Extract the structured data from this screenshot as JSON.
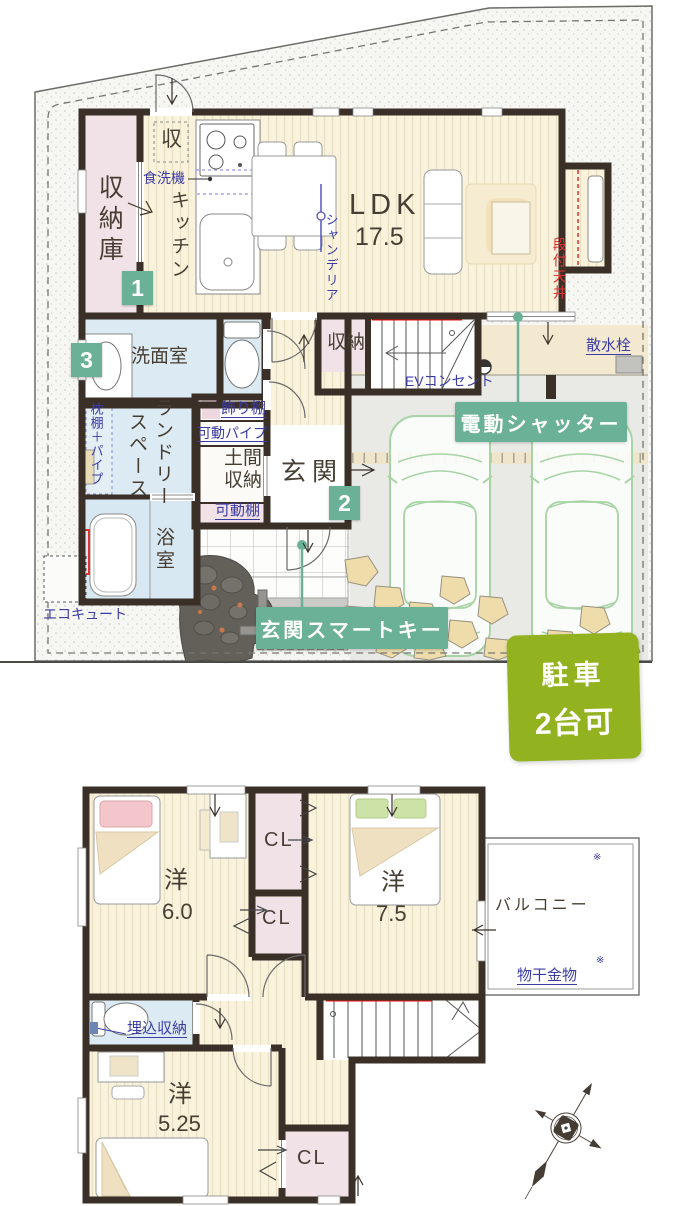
{
  "floor1": {
    "rooms": {
      "storage_room": "収納庫",
      "kitchen": "キッチン",
      "ldk": "LDK",
      "ldk_size": "17.5",
      "stair_storage": "収納",
      "washroom": "洗面室",
      "laundry_1": "ランドリー",
      "laundry_2": "スペース",
      "doma_1": "土間",
      "doma_2": "収納",
      "entrance": "玄関",
      "bathroom": "浴室"
    },
    "annotations": {
      "storage_small": "収",
      "dishwasher": "食洗機",
      "chandelier": "シャンデリア",
      "stepped_ceiling": "段付天井",
      "pillow_shelf": "枕棚＋パイプ",
      "display_shelf": "飾り棚",
      "movable_pipe": "可動パイプ",
      "movable_shelf": "可動棚",
      "ecocute": "エコキュート",
      "ev_outlet": "EVコンセント",
      "sprinkler": "散水栓"
    },
    "badges": {
      "storage": "1",
      "entrance": "2",
      "washroom": "3"
    },
    "callouts": {
      "electric_shutter": "電動シャッター",
      "smart_key": "玄関スマートキー"
    }
  },
  "parking": {
    "line1": "駐車",
    "line2": "2台可"
  },
  "floor2": {
    "rooms": {
      "west1": "洋",
      "west1_size": "6.0",
      "west2": "洋",
      "west2_size": "7.5",
      "west3": "洋",
      "west3_size": "5.25",
      "cl_a": "CL",
      "cl_b": "CL",
      "cl_c": "CL",
      "balcony": "バルコニー"
    },
    "annotations": {
      "hanging_hw": "物干金物",
      "recessed_storage": "埋込収納",
      "ref_mark": "※"
    }
  },
  "colors": {
    "accent_teal": "#6bb197",
    "parking_green": "#93b21f",
    "wall": "#3a3028",
    "annotation_blue": "#3c3ca5",
    "alert_red": "#e23333"
  }
}
